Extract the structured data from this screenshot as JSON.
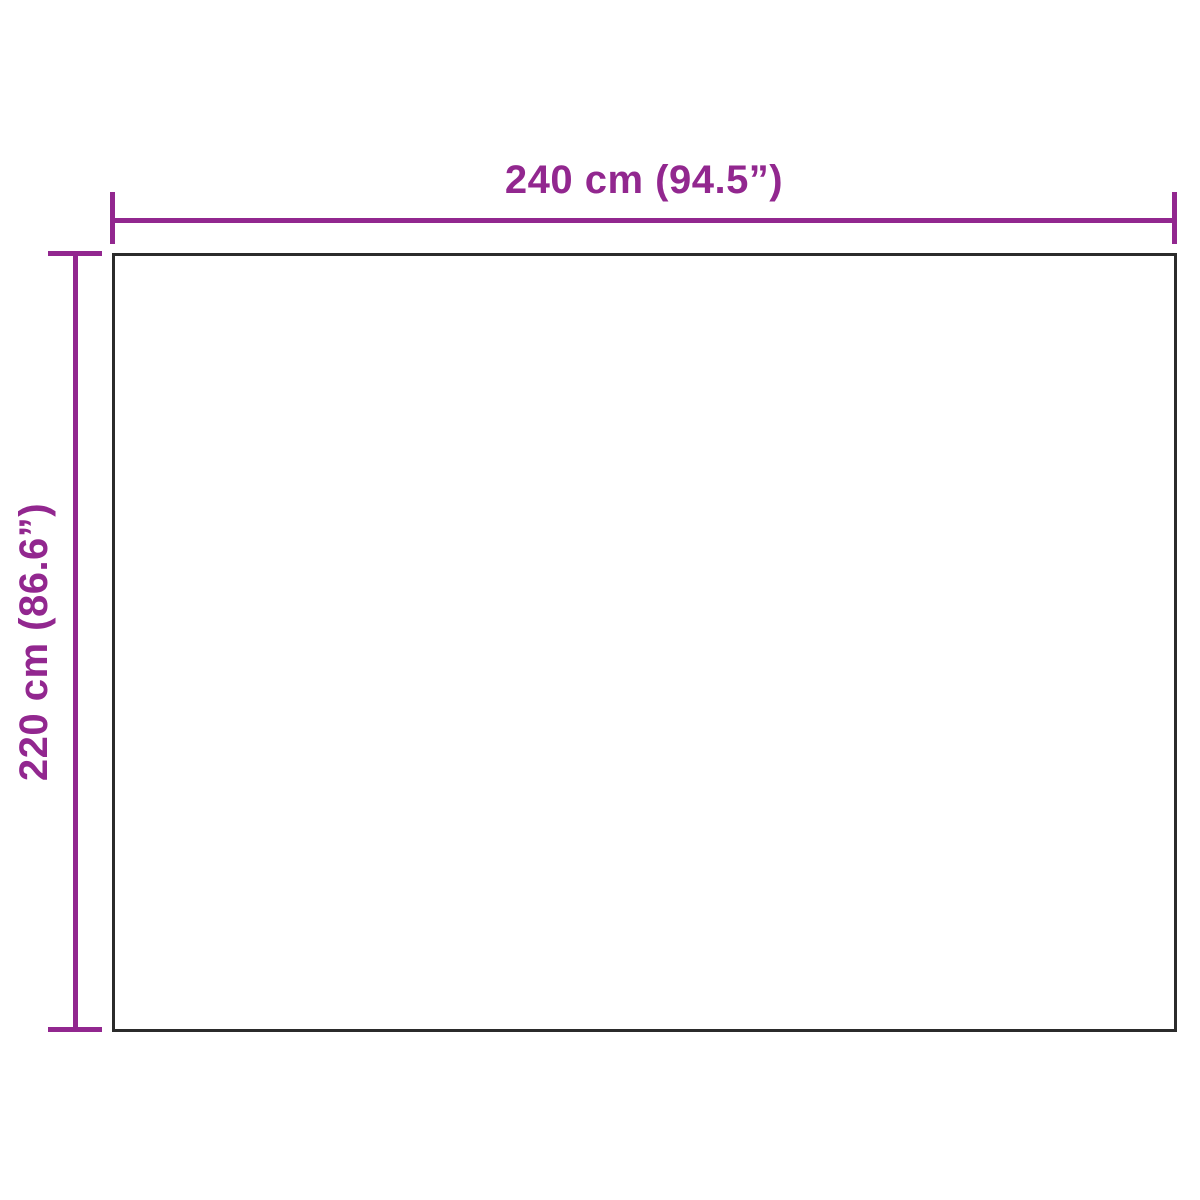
{
  "diagram": {
    "type": "product-dimension-diagram",
    "object": "rectangular-panel",
    "width_label": "240 cm (94.5”)",
    "height_label": "220 cm (86.6”)",
    "width_cm": 240,
    "width_inches": 94.5,
    "height_cm": 220,
    "height_inches": 86.6,
    "accent_color": "#92278F",
    "outline_color": "#2b2b2b",
    "background_color": "#ffffff"
  }
}
